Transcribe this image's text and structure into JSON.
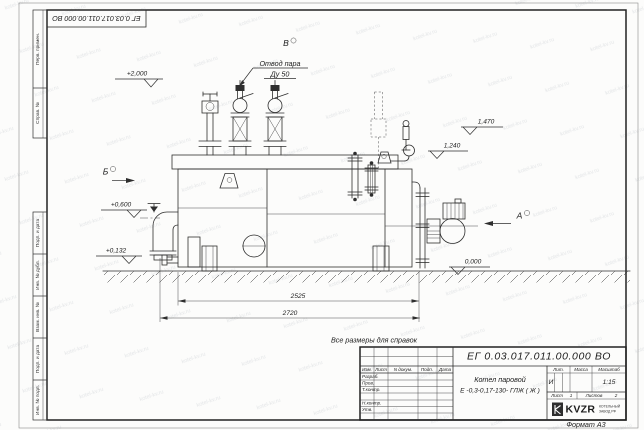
{
  "sheet": {
    "corner_doc_number": "ЕГ 0.03.017.011.00.000  ВО",
    "format_label": "Формат А3",
    "watermark_text": "kotel-kv.ru"
  },
  "side_column": {
    "cells": [
      "Перв. примен.",
      "Справ. №",
      "Подп. и дата",
      "Инв. № дубл.",
      "Взам. инв. №",
      "Подп. и дата",
      "Инв. № подл."
    ]
  },
  "drawing": {
    "note": "Все размеры для справок",
    "views": {
      "a": "А",
      "b": "Б",
      "v": "В"
    },
    "callout_line1": "Отвод пара",
    "callout_line2": "Ду 50",
    "elevations": {
      "e2000": "+2,000",
      "e0600": "+0,600",
      "e0132": "+0,132",
      "e1470": "1,470",
      "e1240": "1,240",
      "e0000": "0,000"
    },
    "dimensions": {
      "d2525": "2525",
      "d2720": "2720"
    }
  },
  "title_block": {
    "doc_number": "ЕГ 0.03.017.011.00.000  ВО",
    "product_name": "Котел паровой",
    "product_designation": "Е -0,3-0,17-130- ГЛЖ ( Ж )",
    "header_cols": {
      "izm": "Изм.",
      "list": "Лист",
      "dokum": "N докум.",
      "podp": "Подп.",
      "data": "Дата"
    },
    "role_rows": {
      "razrab": "Разраб.",
      "prov": "Пров.",
      "tkontr": "Т.контр.",
      "nkontr": "Н.контр.",
      "utv": "Утв."
    },
    "lit_label": "Лит.",
    "massa_label": "Масса",
    "masshtab_label": "Масштаб",
    "lit_value": "И",
    "scale_value": "1:15",
    "list_label": "Лист",
    "list_value": "1",
    "listov_label": "Листов",
    "listov_value": "2",
    "company_logo": "KVZR",
    "company_line1": "КОТЕЛЬНЫЙ",
    "company_line2": "ЗАВОД РФ"
  }
}
